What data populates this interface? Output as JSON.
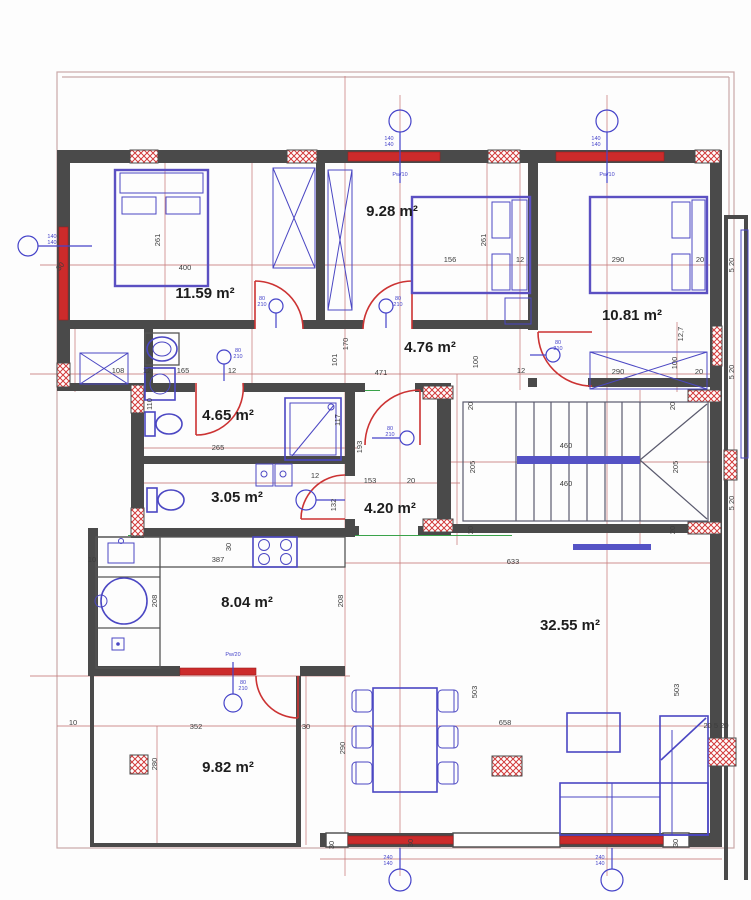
{
  "drawing": {
    "type": "architectural-floor-plan"
  },
  "colors": {
    "wall": "#4a4a4a",
    "window_red": "#cc2b2b",
    "dimension_red": "#c97d7d",
    "furniture_blue": "#4b47c3",
    "green_line": "#3aa34a",
    "hatch_red": "#d23b3b",
    "label_black": "#1d1d1d"
  },
  "rooms": [
    {
      "id": "bedroom-left",
      "area": "11.59 m²"
    },
    {
      "id": "bedroom-middle",
      "area": "9.28 m²"
    },
    {
      "id": "bedroom-right",
      "area": "10.81 m²"
    },
    {
      "id": "hallway",
      "area": "4.76 m²"
    },
    {
      "id": "bathroom",
      "area": "4.65 m²"
    },
    {
      "id": "wc",
      "area": "3.05 m²"
    },
    {
      "id": "entry-hall",
      "area": "4.20 m²"
    },
    {
      "id": "kitchen",
      "area": "8.04 m²"
    },
    {
      "id": "living-room",
      "area": "32.55 m²"
    },
    {
      "id": "terrace",
      "area": "9.82 m²"
    }
  ],
  "dimensions": [
    {
      "t": "400",
      "x": 185,
      "y": 270
    },
    {
      "t": "261",
      "x": 160,
      "y": 240,
      "v": 1
    },
    {
      "t": "30",
      "x": 62,
      "y": 268,
      "r": -50
    },
    {
      "t": "156",
      "x": 450,
      "y": 262
    },
    {
      "t": "261",
      "x": 486,
      "y": 240,
      "v": 1
    },
    {
      "t": "12",
      "x": 520,
      "y": 262
    },
    {
      "t": "290",
      "x": 618,
      "y": 262
    },
    {
      "t": "20",
      "x": 700,
      "y": 262
    },
    {
      "t": "108",
      "x": 118,
      "y": 373
    },
    {
      "t": "12",
      "x": 147,
      "y": 373
    },
    {
      "t": "165",
      "x": 183,
      "y": 373
    },
    {
      "t": "12",
      "x": 232,
      "y": 373
    },
    {
      "t": "471",
      "x": 381,
      "y": 375
    },
    {
      "t": "101",
      "x": 337,
      "y": 360,
      "v": 1
    },
    {
      "t": "170",
      "x": 348,
      "y": 344,
      "v": 1
    },
    {
      "t": "100",
      "x": 478,
      "y": 362,
      "v": 1
    },
    {
      "t": "12",
      "x": 521,
      "y": 373
    },
    {
      "t": "290",
      "x": 618,
      "y": 374
    },
    {
      "t": "100",
      "x": 677,
      "y": 363,
      "v": 1
    },
    {
      "t": "20",
      "x": 699,
      "y": 374
    },
    {
      "t": "12,7",
      "x": 683,
      "y": 334,
      "v": 1
    },
    {
      "t": "110",
      "x": 152,
      "y": 404,
      "v": 1
    },
    {
      "t": "265",
      "x": 218,
      "y": 450
    },
    {
      "t": "117",
      "x": 340,
      "y": 420,
      "v": 1
    },
    {
      "t": "193",
      "x": 362,
      "y": 447,
      "v": 1
    },
    {
      "t": "153",
      "x": 370,
      "y": 483
    },
    {
      "t": "20",
      "x": 411,
      "y": 483
    },
    {
      "t": "12",
      "x": 315,
      "y": 478
    },
    {
      "t": "132",
      "x": 336,
      "y": 505,
      "v": 1
    },
    {
      "t": "205",
      "x": 475,
      "y": 467,
      "v": 1
    },
    {
      "t": "205",
      "x": 678,
      "y": 467,
      "v": 1
    },
    {
      "t": "460",
      "x": 566,
      "y": 448
    },
    {
      "t": "460",
      "x": 566,
      "y": 486
    },
    {
      "t": "20",
      "x": 473,
      "y": 406,
      "v": 1
    },
    {
      "t": "20",
      "x": 675,
      "y": 406,
      "v": 1
    },
    {
      "t": "20",
      "x": 473,
      "y": 530,
      "v": 1
    },
    {
      "t": "20",
      "x": 675,
      "y": 530,
      "v": 1
    },
    {
      "t": "633",
      "x": 513,
      "y": 564
    },
    {
      "t": "658",
      "x": 505,
      "y": 725
    },
    {
      "t": "503",
      "x": 477,
      "y": 692,
      "v": 1
    },
    {
      "t": "503",
      "x": 679,
      "y": 690,
      "v": 1
    },
    {
      "t": "387",
      "x": 218,
      "y": 562
    },
    {
      "t": "208",
      "x": 157,
      "y": 601,
      "v": 1
    },
    {
      "t": "208",
      "x": 343,
      "y": 601,
      "v": 1
    },
    {
      "t": "10",
      "x": 92,
      "y": 562
    },
    {
      "t": "30",
      "x": 231,
      "y": 547,
      "v": 1
    },
    {
      "t": "10",
      "x": 73,
      "y": 725
    },
    {
      "t": "352",
      "x": 196,
      "y": 729
    },
    {
      "t": "30",
      "x": 306,
      "y": 729
    },
    {
      "t": "280",
      "x": 157,
      "y": 764,
      "v": 1
    },
    {
      "t": "290",
      "x": 345,
      "y": 748,
      "v": 1
    },
    {
      "t": "30",
      "x": 334,
      "y": 845,
      "v": 1
    },
    {
      "t": "30",
      "x": 413,
      "y": 843,
      "v": 1
    },
    {
      "t": "30",
      "x": 678,
      "y": 843,
      "v": 1
    },
    {
      "t": "5 20",
      "x": 734,
      "y": 265,
      "v": 1
    },
    {
      "t": "5 20",
      "x": 734,
      "y": 372,
      "v": 1
    },
    {
      "t": "5 20",
      "x": 734,
      "y": 503,
      "v": 1
    },
    {
      "t": "20 5 20",
      "x": 716,
      "y": 728
    }
  ],
  "window_markers": [
    {
      "cx": 400,
      "cy": 121,
      "r": 11,
      "stem": [
        400,
        132,
        400,
        183
      ],
      "tag1": "140",
      "tag2": "140",
      "tx": 389,
      "ty": 140,
      "label": "Pw/10",
      "lx": 400,
      "ly": 176
    },
    {
      "cx": 607,
      "cy": 121,
      "r": 11,
      "stem": [
        607,
        132,
        607,
        183
      ],
      "tag1": "140",
      "tag2": "140",
      "tx": 596,
      "ty": 140,
      "label": "Pw/10",
      "lx": 607,
      "ly": 176
    },
    {
      "cx": 28,
      "cy": 246,
      "r": 10,
      "stem": [
        38,
        246,
        92,
        246
      ],
      "tag1": "140",
      "tag2": "140",
      "tx": 52,
      "ty": 238
    },
    {
      "cx": 400,
      "cy": 880,
      "r": 11,
      "stem": [
        400,
        869,
        400,
        848
      ],
      "tag1": "240",
      "tag2": "140",
      "tx": 388,
      "ty": 859
    },
    {
      "cx": 612,
      "cy": 880,
      "r": 11,
      "stem": [
        612,
        869,
        612,
        848
      ],
      "tag1": "240",
      "tag2": "140",
      "tx": 600,
      "ty": 859
    },
    {
      "cx": 233,
      "cy": 703,
      "r": 9,
      "stem": [
        233,
        694,
        233,
        662
      ],
      "tag1": "80",
      "tag2": "210",
      "tx": 243,
      "ty": 684,
      "label": "Pw/20",
      "lx": 233,
      "ly": 656
    }
  ],
  "door_markers": [
    {
      "cx": 276,
      "cy": 306,
      "r": 7,
      "stem": [
        276,
        313,
        276,
        328
      ],
      "tag1": "80",
      "tag2": "210",
      "tx": 262,
      "ty": 300
    },
    {
      "cx": 386,
      "cy": 306,
      "r": 7,
      "stem": [
        386,
        313,
        386,
        328
      ],
      "tag1": "80",
      "tag2": "210",
      "tx": 398,
      "ty": 300
    },
    {
      "cx": 553,
      "cy": 355,
      "r": 7,
      "stem": [
        546,
        355,
        530,
        355
      ],
      "tag1": "80",
      "tag2": "210",
      "tx": 558,
      "ty": 344
    },
    {
      "cx": 224,
      "cy": 357,
      "r": 7,
      "stem": [
        224,
        364,
        224,
        381
      ],
      "tag1": "80",
      "tag2": "210",
      "tx": 238,
      "ty": 352
    },
    {
      "cx": 407,
      "cy": 438,
      "r": 7,
      "stem": [
        400,
        438,
        372,
        438
      ],
      "tag1": "80",
      "tag2": "210",
      "tx": 390,
      "ty": 430
    }
  ]
}
